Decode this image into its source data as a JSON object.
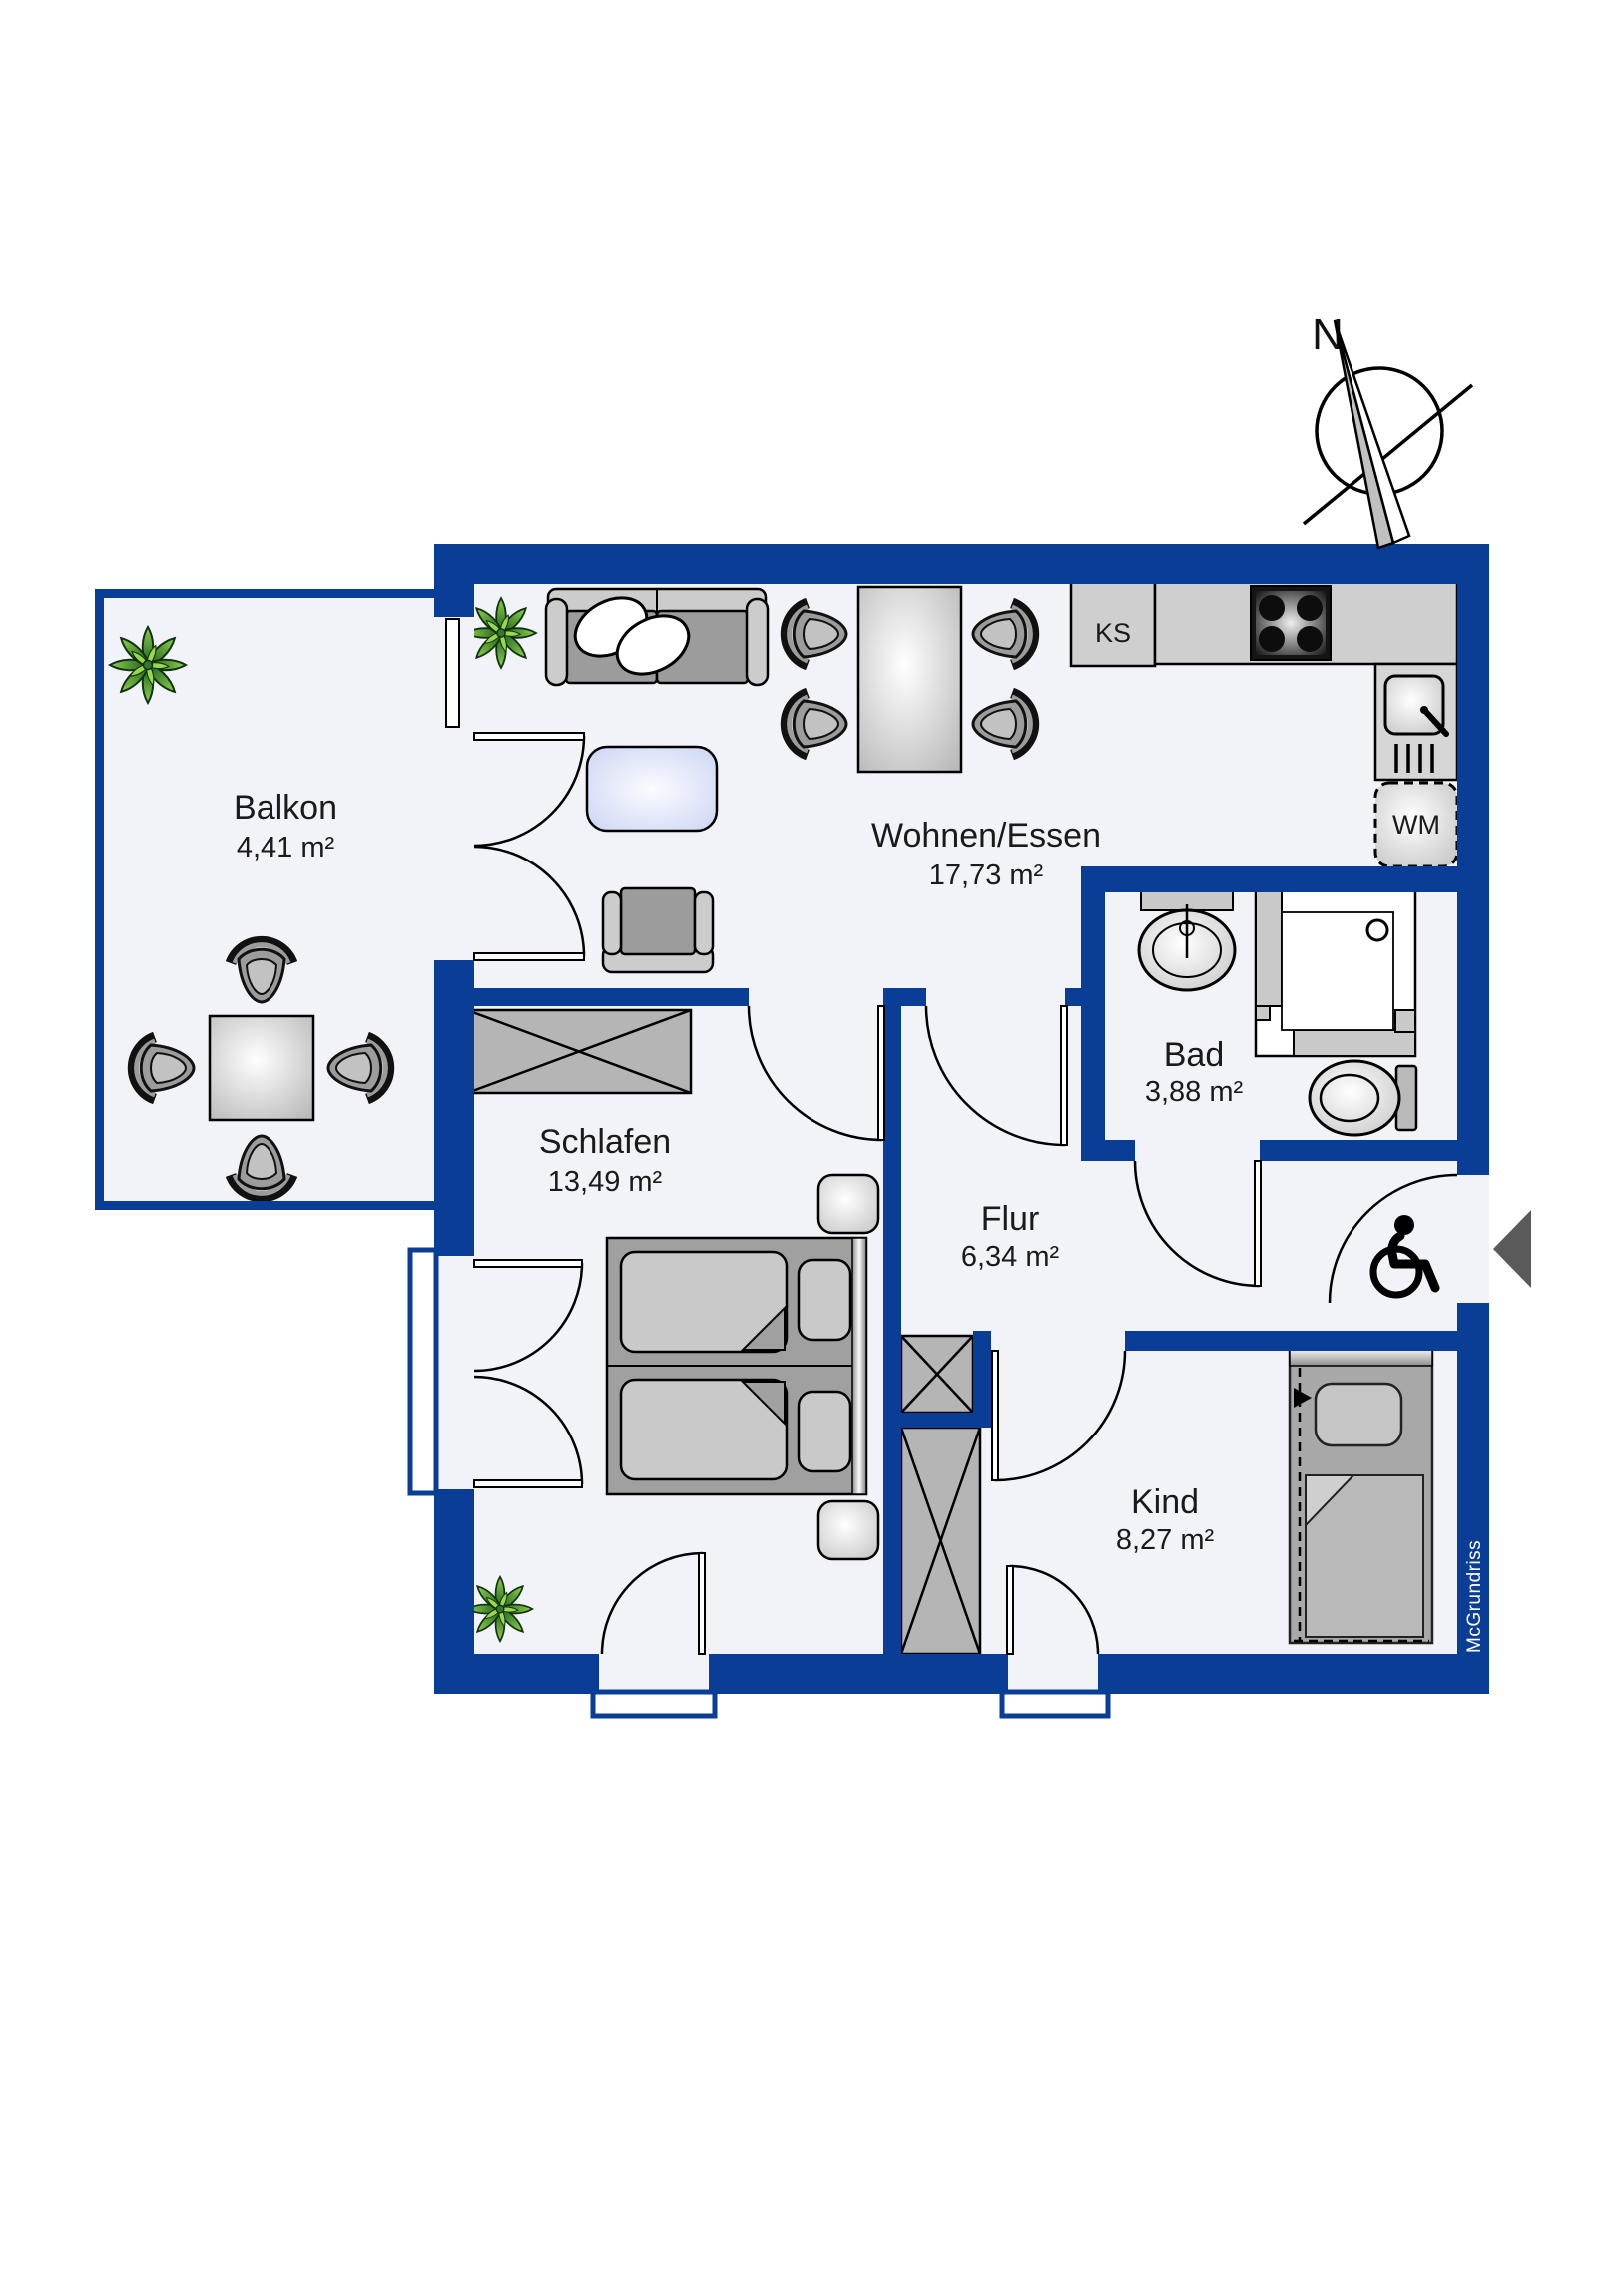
{
  "title": "Apartment floor plan",
  "colors": {
    "wall": "#0a3d96",
    "floor": "#f2f3f8",
    "page": "#ffffff",
    "furniture_gray": "#9c9c9c",
    "leaf_green": "#5cb032"
  },
  "rooms": [
    {
      "name": "Balkon",
      "area": "4,41 m²"
    },
    {
      "name": "Wohnen/Essen",
      "area": "17,73 m²"
    },
    {
      "name": "Schlafen",
      "area": "13,49 m²"
    },
    {
      "name": "Flur",
      "area": "6,34 m²"
    },
    {
      "name": "Bad",
      "area": "3,88 m²"
    },
    {
      "name": "Kind",
      "area": "8,27 m²"
    }
  ],
  "appliances": {
    "fridge": "KS",
    "washing_machine": "WM"
  },
  "compass": {
    "north": "N"
  },
  "brand": "McGrundriss"
}
